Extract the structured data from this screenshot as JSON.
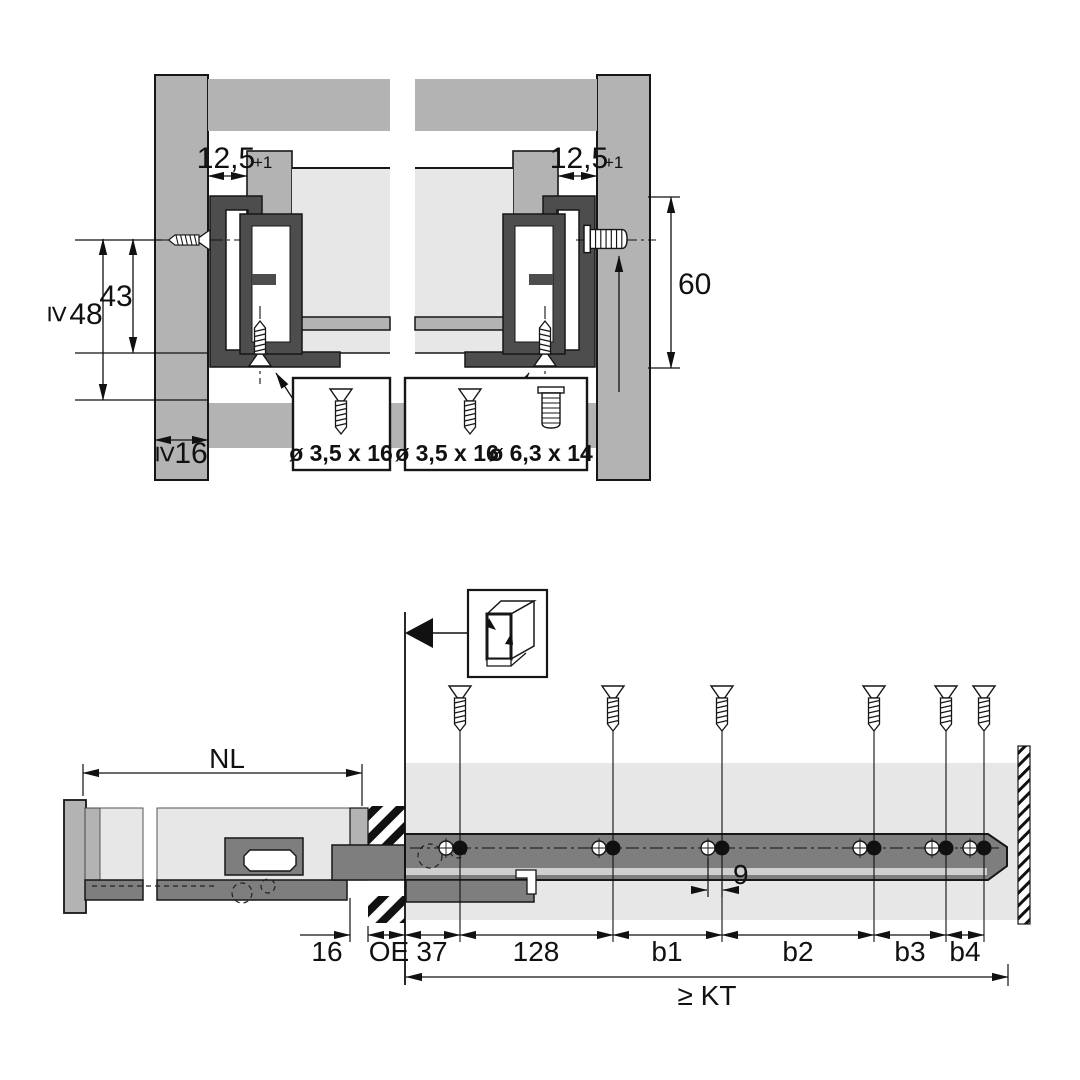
{
  "figure_type": "drawer-slide-installation-drawing",
  "colors": {
    "panel_gray": "#b3b3b3",
    "drawer_light_gray": "#e7e7e7",
    "slide_profile_dark": "#4d4d4d",
    "rail_gray": "#7e7e7e",
    "outline": "#161616",
    "background": "#ffffff"
  },
  "top_figure": {
    "dim_gap_left": "12,5",
    "dim_gap_left_tol": "+1",
    "dim_gap_right": "12,5",
    "dim_gap_right_tol": "+1",
    "dim_screw_height": "43",
    "geq_symbol": "≥",
    "dim_min_side_height": "48",
    "dim_rail_height": "60",
    "dim_min_side_thickness": "16",
    "screw_box_left_label": "ø 3,5 x 16",
    "screw_box_right_label_a": "ø 3,5 x 16",
    "screw_box_right_label_b": "ø 6,3 x 14"
  },
  "bottom_figure": {
    "dim_nominal_length": "NL",
    "dim_back_inset": "16",
    "dim_front_offset": "OE",
    "dim_first_hole": "37",
    "dim_second_hole": "128",
    "dim_b1": "b1",
    "dim_b2": "b2",
    "dim_b3": "b3",
    "dim_b4": "b4",
    "dim_hole_pair_spacing": "9",
    "dim_min_cabinet_depth": "≥ KT"
  }
}
